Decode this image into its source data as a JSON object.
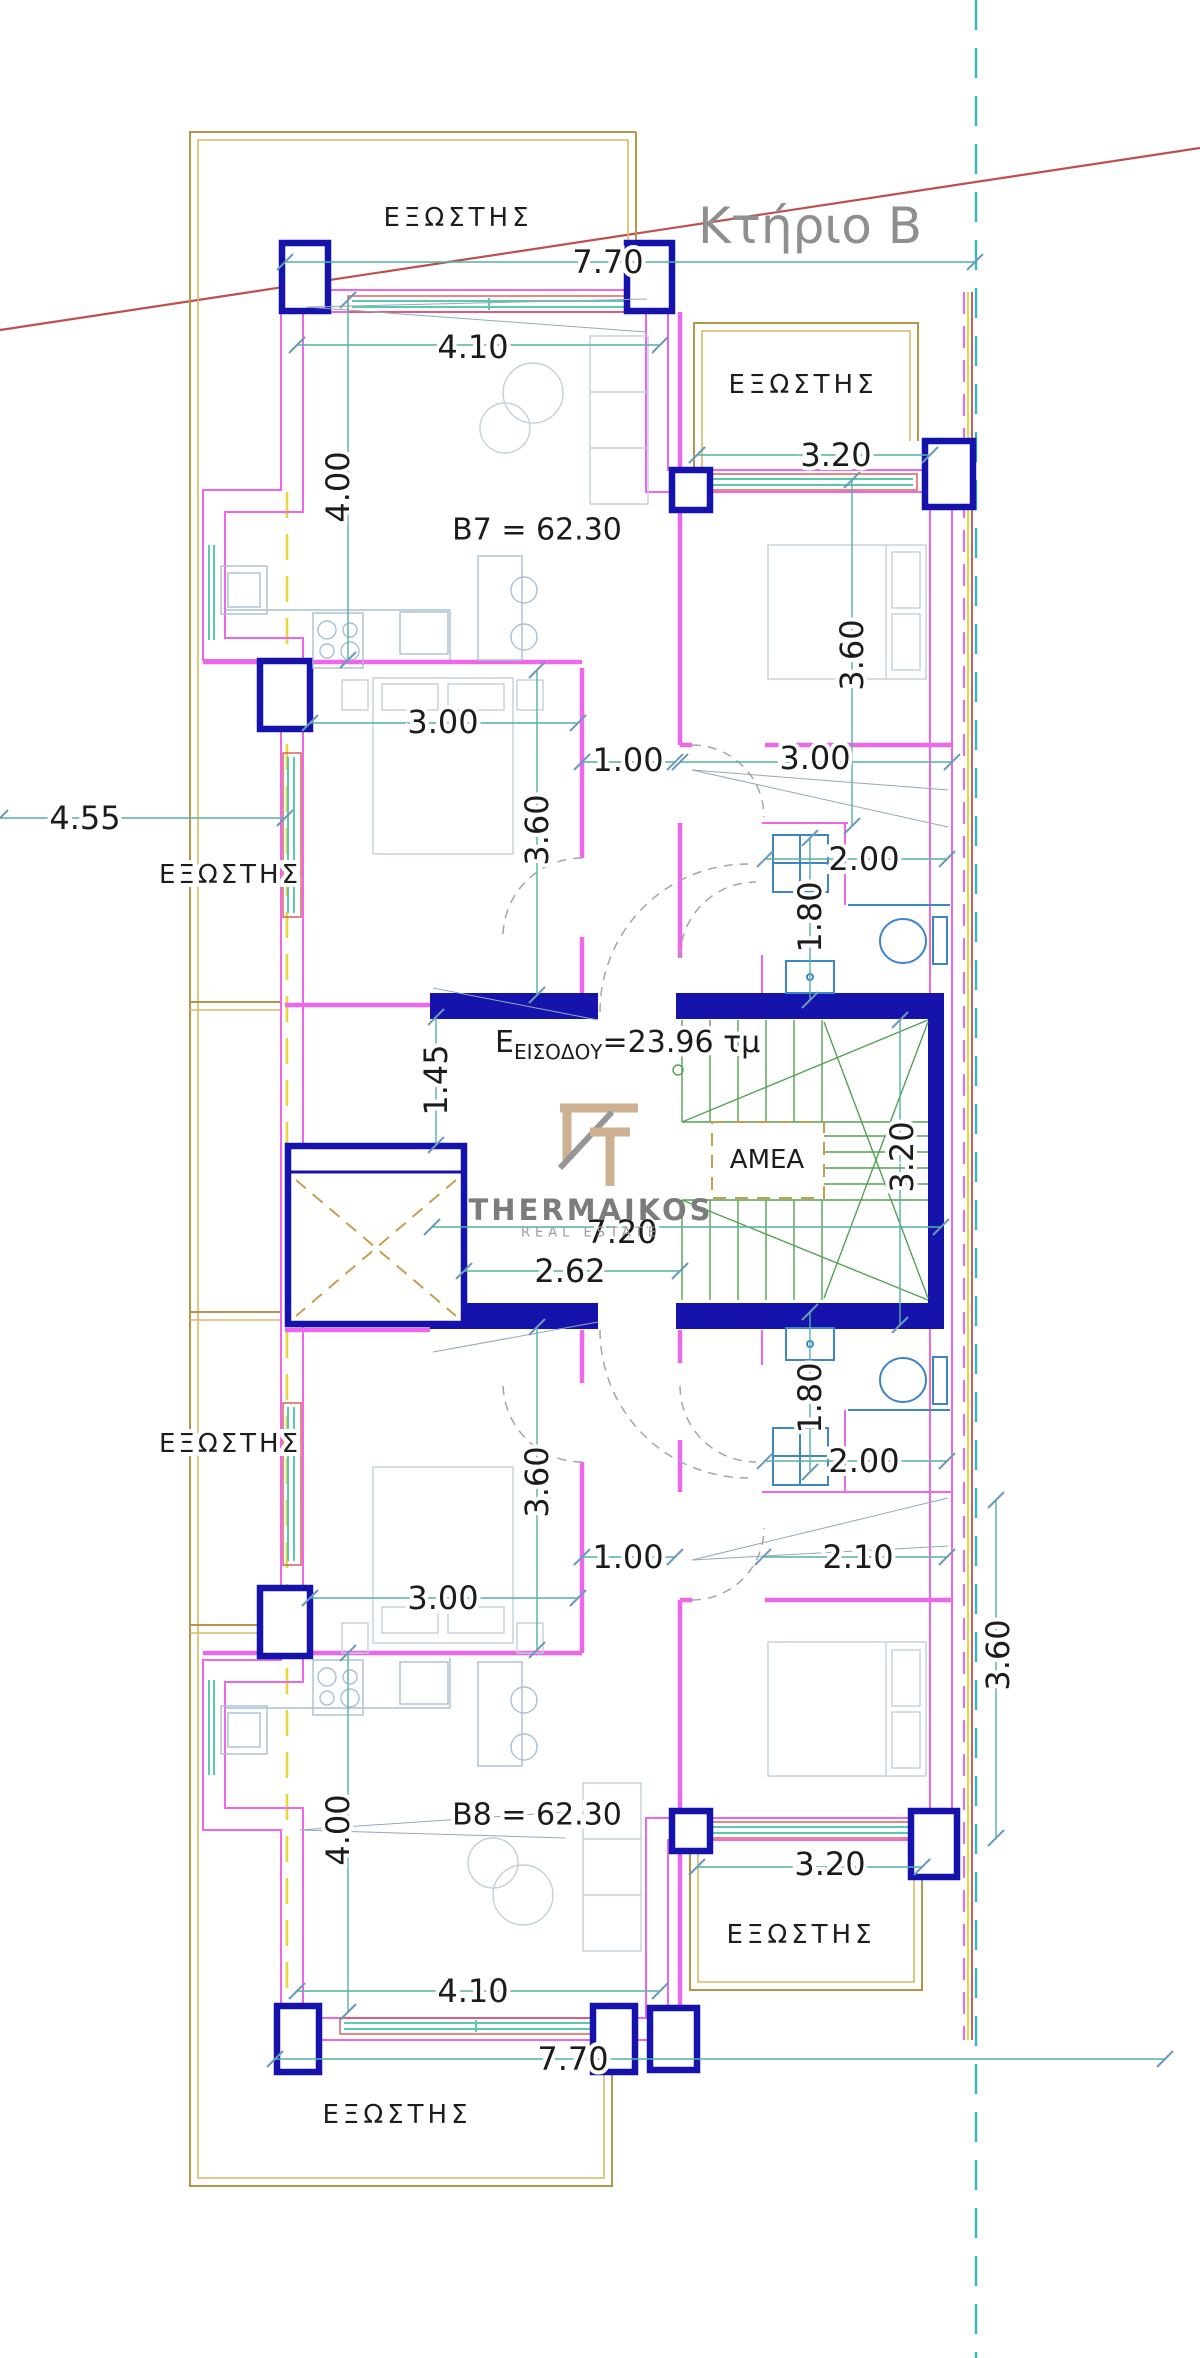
{
  "drawing": {
    "building_title": "Κτήριο Β",
    "apartment_upper_label": "B7 = 62.30",
    "apartment_lower_label": "B8 = 62.30",
    "entrance_area_label": {
      "prefix": "Ε",
      "subscript": "ΕΙΣΟΔΟΥ",
      "value": "=23.96 τμ"
    },
    "accessibility_platform_label": "AMEA",
    "balcony_label": "ΕΞΩΣΤΗΣ"
  },
  "watermark": {
    "brand": "THERMAIKOS",
    "tagline": "REAL ESTATE"
  },
  "colors": {
    "wall": "#ee66ea",
    "column": "#1513ac",
    "balcony": "#b3964a",
    "balcony_light": "#d6ba66",
    "window": "#5cc9ae",
    "window_frame": "#d9574f",
    "dimension": "#53b1a5",
    "stairs": "#54a254",
    "bath_fixture": "#3f86c9",
    "furniture": "#a9bfd3",
    "boundary_cyan": "#35b6c9",
    "axis_yellow": "#e8d73c",
    "section_red": "#bf4f4f",
    "text_ink": "#1c1c1c",
    "title_gray": "#8f8f8f",
    "logo_tan": "#c9a987"
  },
  "texts": [
    {
      "n": "building-title",
      "t": "Κτήριο Β",
      "x": 810,
      "y": 226,
      "s": 50,
      "c": "#8f8f8f",
      "halo": false
    },
    {
      "n": "balcony-label-top",
      "t": "ΕΞΩΣΤΗΣ",
      "x": 458,
      "y": 218,
      "s": 26,
      "ls": 4
    },
    {
      "n": "balcony-label-top-right",
      "t": "ΕΞΩΣΤΗΣ",
      "x": 803,
      "y": 385,
      "s": 26,
      "ls": 4
    },
    {
      "n": "balcony-label-left-upper",
      "t": "ΕΞΩΣΤΗΣ",
      "x": 230,
      "y": 875,
      "s": 26,
      "ls": 3
    },
    {
      "n": "balcony-label-left-lower",
      "t": "ΕΞΩΣΤΗΣ",
      "x": 230,
      "y": 1444,
      "s": 26,
      "ls": 3
    },
    {
      "n": "balcony-label-bottom-right",
      "t": "ΕΞΩΣΤΗΣ",
      "x": 801,
      "y": 1935,
      "s": 26,
      "ls": 4
    },
    {
      "n": "balcony-label-bottom",
      "t": "ΕΞΩΣΤΗΣ",
      "x": 397,
      "y": 2115,
      "s": 26,
      "ls": 4
    },
    {
      "n": "room-label-b7",
      "t": "B7 = 62.30",
      "x": 537,
      "y": 530,
      "s": 30
    },
    {
      "n": "room-label-b8",
      "t": "B8 = 62.30",
      "x": 537,
      "y": 1815,
      "s": 30
    },
    {
      "n": "label-amea",
      "t": "AMEA",
      "x": 767,
      "y": 1160,
      "s": 26
    },
    {
      "n": "dim-770-top",
      "t": "7.70",
      "x": 608,
      "y": 262,
      "s": 32
    },
    {
      "n": "dim-410-top",
      "t": "4.10",
      "x": 473,
      "y": 347,
      "s": 32
    },
    {
      "n": "dim-400-upper",
      "t": "4.00",
      "x": 338,
      "y": 487,
      "s": 32,
      "r": -90
    },
    {
      "n": "dim-320-top-right",
      "t": "3.20",
      "x": 836,
      "y": 455,
      "s": 32
    },
    {
      "n": "dim-360-top-right",
      "t": "3.60",
      "x": 852,
      "y": 655,
      "s": 32,
      "r": -90
    },
    {
      "n": "dim-455-left",
      "t": "4.55",
      "x": 85,
      "y": 818,
      "s": 32
    },
    {
      "n": "dim-300-upper-left",
      "t": "3.00",
      "x": 443,
      "y": 722,
      "s": 32
    },
    {
      "n": "dim-100-upper",
      "t": "1.00",
      "x": 628,
      "y": 760,
      "s": 32
    },
    {
      "n": "dim-300-upper-right",
      "t": "3.00",
      "x": 815,
      "y": 758,
      "s": 32
    },
    {
      "n": "dim-360-upper-left",
      "t": "3.60",
      "x": 537,
      "y": 830,
      "s": 32,
      "r": -90
    },
    {
      "n": "dim-200-upper-bath",
      "t": "2.00",
      "x": 864,
      "y": 859,
      "s": 32
    },
    {
      "n": "dim-180-upper-bath",
      "t": "1.80",
      "x": 810,
      "y": 917,
      "s": 32,
      "r": -90
    },
    {
      "n": "dim-145-hall",
      "t": "1.45",
      "x": 436,
      "y": 1080,
      "s": 32,
      "r": -90
    },
    {
      "n": "dim-320-stair",
      "t": "3.20",
      "x": 902,
      "y": 1157,
      "s": 32,
      "r": -90
    },
    {
      "n": "dim-720-hall",
      "t": "7.20",
      "x": 622,
      "y": 1232,
      "s": 32
    },
    {
      "n": "dim-262-hall",
      "t": "2.62",
      "x": 570,
      "y": 1271,
      "s": 32
    },
    {
      "n": "dim-180-lower-bath",
      "t": "1.80",
      "x": 810,
      "y": 1398,
      "s": 32,
      "r": -90
    },
    {
      "n": "dim-200-lower-bath",
      "t": "2.00",
      "x": 864,
      "y": 1461,
      "s": 32
    },
    {
      "n": "dim-210-lower",
      "t": "2.10",
      "x": 858,
      "y": 1557,
      "s": 32
    },
    {
      "n": "dim-360-lower-left",
      "t": "3.60",
      "x": 537,
      "y": 1482,
      "s": 32,
      "r": -90
    },
    {
      "n": "dim-100-lower",
      "t": "1.00",
      "x": 628,
      "y": 1557,
      "s": 32
    },
    {
      "n": "dim-300-lower-left",
      "t": "3.00",
      "x": 443,
      "y": 1598,
      "s": 32
    },
    {
      "n": "dim-360-right",
      "t": "3.60",
      "x": 998,
      "y": 1655,
      "s": 32,
      "r": -90
    },
    {
      "n": "dim-400-lower",
      "t": "4.00",
      "x": 338,
      "y": 1830,
      "s": 32,
      "r": -90
    },
    {
      "n": "dim-410-bottom",
      "t": "4.10",
      "x": 473,
      "y": 1991,
      "s": 32
    },
    {
      "n": "dim-770-bottom",
      "t": "7.70",
      "x": 573,
      "y": 2059,
      "s": 32
    },
    {
      "n": "dim-320-bottom-right",
      "t": "3.20",
      "x": 830,
      "y": 1864,
      "s": 32
    },
    {
      "n": "watermark-brand",
      "t": "THERMAIKOS",
      "x": 591,
      "y": 1210,
      "s": 29,
      "c": "#7c7c7c",
      "f": "serif",
      "w": "bold",
      "ls": 3,
      "halo": false
    },
    {
      "n": "watermark-tagline",
      "t": "REAL ESTATE",
      "x": 591,
      "y": 1233,
      "s": 13,
      "c": "#9c9c9c",
      "ls": 5,
      "halo": false
    }
  ],
  "entrance_text": {
    "n": "label-entrance-area",
    "x": 495,
    "y": 1052
  }
}
